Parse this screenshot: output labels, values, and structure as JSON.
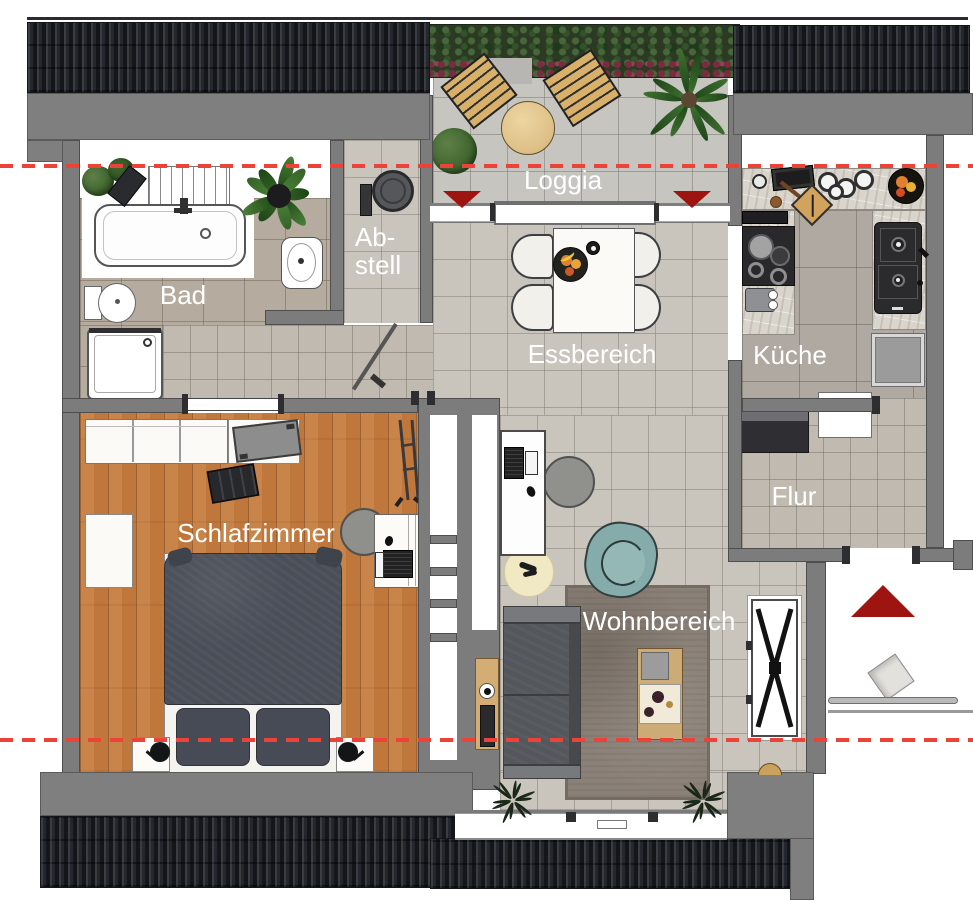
{
  "rooms": {
    "loggia": {
      "label": "Loggia"
    },
    "bad": {
      "label": "Bad"
    },
    "abstell": {
      "label_line1": "Ab-",
      "label_line2": "stell"
    },
    "essbereich": {
      "label": "Essbereich"
    },
    "kueche": {
      "label": "Küche"
    },
    "flur": {
      "label": "Flur"
    },
    "schlafzimmer": {
      "label": "Schlafzimmer"
    },
    "wohnbereich": {
      "label": "Wohnbereich"
    }
  },
  "markers": {
    "section_line_color": "#ec4237",
    "entrance_triangle_color": "#9e1410",
    "loggia_door_triangles": 2,
    "entrance_triangles": 1
  },
  "palette": {
    "wall_gray": "#7c7c7c",
    "roof_dark": "#24272d",
    "tile_light": "#c9c5bd",
    "tile_bath": "#b5ab9e",
    "wood_floor": "#c0773c",
    "bed_dark": "#4a4e58",
    "sofa_gray": "#54575b",
    "armchair_teal": "#86adab",
    "rug_brown": "#8a8077",
    "label_white": "#ffffff"
  },
  "furniture": {
    "loggia": [
      "lounge-chair",
      "lounge-chair",
      "round-table",
      "shrub",
      "palm-plant",
      "hedge"
    ],
    "bad": [
      "bathtub",
      "towel-radiator",
      "toilet",
      "washbasin",
      "shower",
      "plant"
    ],
    "abstell": [
      "washing-machine",
      "wall-device",
      "door-swing"
    ],
    "essbereich": [
      "dining-table",
      "chair",
      "chair",
      "chair",
      "chair",
      "fruit-bowl"
    ],
    "kueche": [
      "cooktop",
      "extractor-hood",
      "coffee-machine",
      "cutting-board",
      "pot-set",
      "sink-unit",
      "fridge",
      "fruit-plate"
    ],
    "flur": [
      "sideboard",
      "doormat"
    ],
    "schlafzimmer": [
      "wardrobe",
      "tv",
      "bench",
      "dresser",
      "double-bed",
      "nightstand",
      "nightstand",
      "lamp",
      "lamp",
      "desk",
      "laptop",
      "office-chair",
      "ladder"
    ],
    "wohnbereich": [
      "desk",
      "laptop",
      "office-chair",
      "round-rug",
      "armchair",
      "sofa",
      "side-table",
      "area-rug",
      "coffee-table",
      "x-leg-console",
      "window-plants"
    ]
  }
}
